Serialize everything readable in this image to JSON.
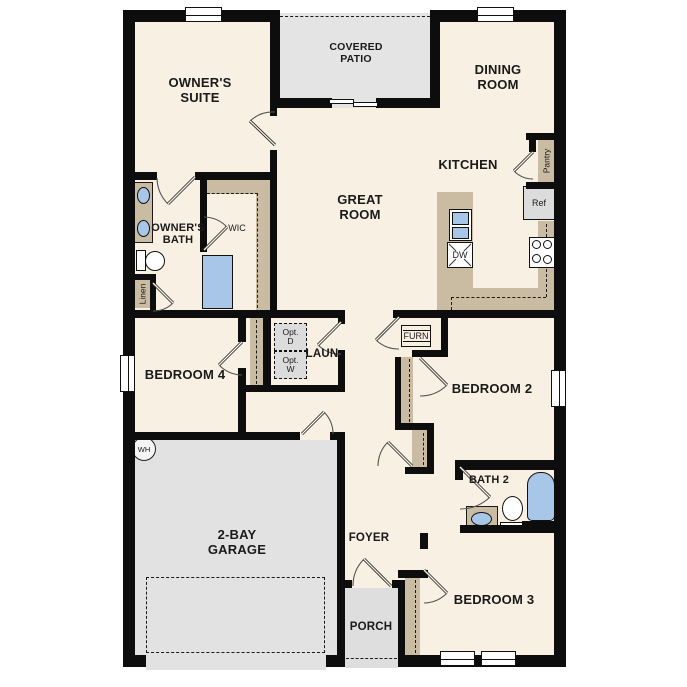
{
  "plan_title": "Single-story floor plan",
  "rooms": {
    "owners_suite": {
      "label": "OWNER'S SUITE"
    },
    "covered_patio": {
      "label": "COVERED PATIO"
    },
    "dining_room": {
      "label": "DINING ROOM"
    },
    "kitchen": {
      "label": "KITCHEN"
    },
    "great_room": {
      "label": "GREAT ROOM"
    },
    "owners_bath": {
      "label": "OWNER'S BATH"
    },
    "wic": {
      "label": "WIC"
    },
    "linen": {
      "label": "Linen"
    },
    "pantry": {
      "label": "Pantry"
    },
    "laundry": {
      "label": "LAUN"
    },
    "bedroom4": {
      "label": "BEDROOM 4"
    },
    "bedroom2": {
      "label": "BEDROOM 2"
    },
    "bedroom3": {
      "label": "BEDROOM 3"
    },
    "garage": {
      "label": "2-BAY GARAGE"
    },
    "foyer": {
      "label": "FOYER"
    },
    "bath2": {
      "label": "BATH 2"
    },
    "porch": {
      "label": "PORCH"
    }
  },
  "fixtures": {
    "ref": "Ref",
    "dw": "DW",
    "furn": "FURN",
    "wh": "WH",
    "opt_dryer": "Opt. D",
    "opt_washer": "Opt. W"
  },
  "colors": {
    "wall": "#0d0d0d",
    "floor": "#f8f0e2",
    "gray": "#e2e2e2",
    "tan": "#c9bca2",
    "blue": "#a8c7e8",
    "appliance": "#dcdcdc"
  }
}
